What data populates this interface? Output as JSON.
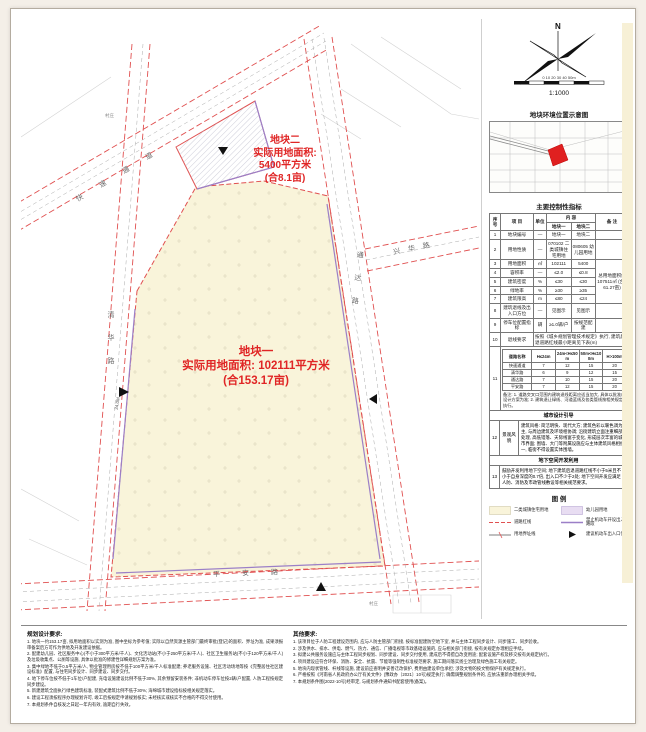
{
  "annotations": {
    "parcel2": {
      "title": "地块二",
      "line2": "实际用地面积:",
      "line3": "5400平方米",
      "line4": "(合8.1亩)"
    },
    "parcel1": {
      "title": "地块一",
      "line2": "实际用地面积: 102111平方米",
      "line3": "(合153.17亩)"
    }
  },
  "map": {
    "roads": [
      {
        "name": "快速通道"
      },
      {
        "name": "清华路"
      },
      {
        "name": "通达路"
      },
      {
        "name": "平安路"
      },
      {
        "name": "兴华路"
      }
    ],
    "labels": {
      "village1": "村庄",
      "village2": "村庄",
      "dim": "24.0M"
    }
  },
  "compass": {
    "north": "N",
    "ticks": "0  10  20  30  40  50m",
    "scale": "1:1000"
  },
  "panel": {
    "location_title": "地块环境位置示意图",
    "table_title": "主要控制性指标",
    "table": {
      "h_no": "序号",
      "h_item": "项 目",
      "h_unit": "单位",
      "h_content": "内 容",
      "h_remark": "备 注",
      "h_p1": "地块一",
      "h_p2": "地块二",
      "rows": [
        {
          "no": "1",
          "item": "地块编号",
          "unit": "—",
          "p1": "地块一",
          "p2": "地块二",
          "remark": ""
        },
        {
          "no": "2",
          "item": "用地性质",
          "unit": "—",
          "p1": "070102 二类城镇住宅用地",
          "p2": "080605 幼儿园用地",
          "remark": ""
        },
        {
          "no": "3",
          "item": "用地面积",
          "unit": "㎡",
          "p1": "102111",
          "p2": "5400",
          "remark": "总用地面积约107511㎡ (合161.27亩)"
        },
        {
          "no": "4",
          "item": "容积率",
          "unit": "—",
          "p1": "≤2.0",
          "p2": "≤0.8"
        },
        {
          "no": "5",
          "item": "建筑密度",
          "unit": "%",
          "p1": "≤30",
          "p2": "≤30"
        },
        {
          "no": "6",
          "item": "绿地率",
          "unit": "%",
          "p1": "≥30",
          "p2": "≥35"
        },
        {
          "no": "7",
          "item": "建筑限高",
          "unit": "m",
          "p1": "≤80",
          "p2": "≤24"
        },
        {
          "no": "8",
          "item": "建筑退线及出入口方位",
          "unit": "—",
          "p1": "见图示",
          "p2": "见图示",
          "remark": ""
        },
        {
          "no": "9",
          "item": "停车位配置指标",
          "unit": "辆",
          "p1": "≥1.0辆/户",
          "p2": "按规范配建",
          "remark": ""
        }
      ],
      "row10": {
        "no": "10",
        "item": "退线要求",
        "text": "按照《城乡规划管理技术规定》执行, 建筑后退道路红线最小距离见下表(m)"
      },
      "setback": {
        "no": "11",
        "label": "后退道路红线最小距离",
        "h_road": "道路名称",
        "cols": [
          "H≤24m",
          "24m<H≤50m",
          "50m<H≤100m",
          "H>100m"
        ],
        "rows": [
          {
            "road": "快速通道",
            "v": [
              "7",
              "12",
              "15",
              "20"
            ]
          },
          {
            "road": "清华路",
            "v": [
              "6",
              "9",
              "12",
              "15"
            ]
          },
          {
            "road": "通达路",
            "v": [
              "7",
              "10",
              "15",
              "20"
            ]
          },
          {
            "road": "平安路",
            "v": [
              "7",
              "12",
              "15",
              "20"
            ]
          }
        ]
      },
      "note": "备注: 1. 道路交叉口范围内建筑退线距离应适当加大, 具体以批准的设计方案为准; 2. 建筑退让绿线、河道蓝线及各类管线按相关规定执行。"
    },
    "design_title": "城市设计引导",
    "design_no": "12",
    "design_label": "景观风貌",
    "design_text": "建筑风格: 简洁明快、现代大方; 建筑色彩以暖色调为主, 与周边建筑及环境相协调; 沿街建筑立面注重细部处理, 高低错落、天际线富于变化, 形成层次丰富的城市界面; 围墙、大门等附属设施应与主体建筑风格相统一, 临街不得设置实体围墙。",
    "underground_title": "地下空间开发利用",
    "underground_no": "13",
    "underground_text": "鼓励开发利用地下空间; 地下建筑后退道路红线不小于5米且不小于自身深度的0.7倍, 出入口不少于2处; 地下空间开发应满足人防、消防及市政管线敷设等相关规范要求。",
    "legend_title": "图  例",
    "legend": {
      "items": [
        {
          "label": "二类城镇住宅用地"
        },
        {
          "label": "幼儿园用地"
        },
        {
          "label": "道路红线"
        },
        {
          "label": "禁止机动车开设出入口路段"
        },
        {
          "label": "用地界址线"
        },
        {
          "label": "建议机动车出入口位置"
        }
      ]
    },
    "colors": {
      "residential": "#f9f4da",
      "kindergarten": "#e8ddf2",
      "redline": "#e05050",
      "purple": "#9b7fc7"
    }
  },
  "notes_left": {
    "title": "规划设计要求:",
    "items": [
      "1. 地块一约153.17亩, 拟用地面积以实测为准, 图中坐标为参考值; 实际以自然资源主管部门最终审批(登记)的面积、界址为准, 成果须报审备案后方可作为供地及开发建设依据。",
      "2. 配建幼儿园、社区服务中心(不小于300平方米/千人)、文化活动站(不小于250平方米/千人)、社区卫生服务站(不小于120平方米/千人)及垃圾收集点、公厕等设施, 具体以批准的修建性详细规划方案为准。",
      "3. 集中绿地不低于0.5平方米/人, 物业管理用房按不低于100平方米/千人标准配建; 养老服务设施、社区活动场地等按《完整居住社区建设标准》配置, 与住宅同步设计、同步建设、同步交付。",
      "4. 地下停车位按不低于1车位/户配建, 充电设施建设比例不低于30%, 其余预留安装条件; 非机动车停车位按2辆/户配置, 人防工程按规定同步建设。",
      "5. 新建建筑全面执行绿色建筑标准, 装配式建筑比例不低于30%; 海绵城市建设指标按相关规定落实。",
      "6. 建设工程须按程序办理规划许可, 竣工后按规定申请规划核实; 未经核实或核实不合格的不得交付使用。",
      "7. 本规划条件自核发之日起一年内有效, 逾期自行失效。"
    ]
  },
  "notes_right": {
    "title": "其他要求:",
    "items": [
      "1. 该项目位于人防工程建设范围内, 应与人防主管部门衔接, 按标准配建防空地下室, 并与主体工程同步设计、同步施工、同步验收。",
      "2. 涉及供水、排水、供电、燃气、热力、通信、广播电视等市政基础设施的, 应与相关部门衔接, 按有关规定办理相应手续。",
      "3. 拟建公共服务设施应与主体工程同步规划、同步建设、同步交付使用, 建成后不得擅自改变用途; 配套设施产权及移交按有关规定执行。",
      "4. 项目建设应符合环保、消防、安全、抗震、节能等强制性标准规范要求, 施工期间落实扬尘治理及绿色施工有关规定。",
      "5. 地块内现状管线、杆线等设施, 建设前应查明并妥善迁改保护, 费用由建设单位承担; 涉及文物的按文物保护有关规定执行。",
      "6. 严格按照《河南省人民政府办公厅有关文件》(豫政办〔2021〕10号)规定执行; 确需调整规划条件的, 应依法重新办理相关手续。",
      "7. 本规划条件图(2022-10号)经审定, 与规划条件通知书配套使用(备案)。"
    ]
  }
}
